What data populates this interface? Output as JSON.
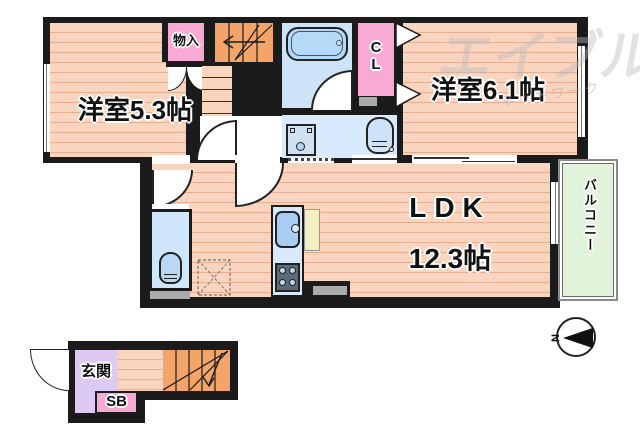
{
  "watermark": {
    "brand": "エイブル",
    "sub": "ネットワーク"
  },
  "rooms": {
    "bedroom1": {
      "label": "洋室5.3帖"
    },
    "bedroom2": {
      "label": "洋室6.1帖"
    },
    "ldk": {
      "name": "LDK",
      "size": "12.3帖"
    },
    "storage": {
      "label": "物入"
    },
    "closet": {
      "label": "CL"
    },
    "balcony": {
      "label": "バルコニー"
    },
    "entrance": {
      "label": "玄関"
    },
    "shoebox": {
      "label": "SB"
    }
  },
  "compass": {
    "north": "N"
  },
  "colors": {
    "wall": "#1b1b1b",
    "floor": "#f9d5bf",
    "floor_stripe": "#e7af92",
    "stairs_orange": "#f2a469",
    "closet_pink": "#f8a9d4",
    "bath_blue": "#cde4f8",
    "washroom_blue": "#d8eafc",
    "fixture_blue": "#a9cdf2",
    "entrance_purple": "#dccaf2",
    "balcony_green": "#e1f3da",
    "counter_cream": "#f3eec0",
    "threshold_gray": "#ababab"
  }
}
